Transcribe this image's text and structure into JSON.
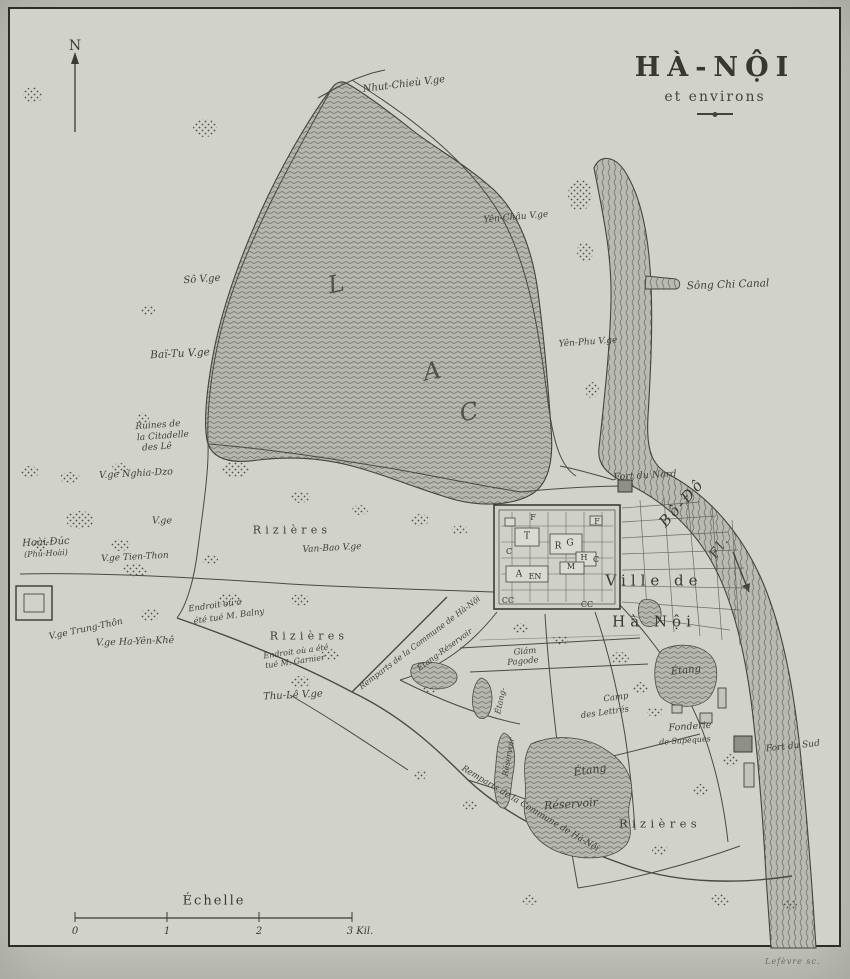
{
  "title": {
    "main": "HÀ-NỘI",
    "sub": "et environs"
  },
  "compass": {
    "label": "N"
  },
  "scale": {
    "label": "Échelle",
    "ticks": [
      "0",
      "1",
      "2",
      "3 Kil."
    ]
  },
  "credit": "Lefèvre sc.",
  "colors": {
    "paper": "#d1d2c9",
    "ink": "#3b3935",
    "water_base": "#b6b7ae",
    "water_line": "#6b6c63",
    "frame": "#2e2c27"
  },
  "labels": [
    {
      "text": "Nhut-Chieù V.ge",
      "x": 404,
      "y": 85,
      "s": 10,
      "r": -7,
      "cls": "i",
      "n": "label-nhut-chieu-village"
    },
    {
      "text": "Yên-Châu V.ge",
      "x": 516,
      "y": 218,
      "s": 9,
      "r": -5,
      "cls": "i",
      "n": "label-yen-chau-village"
    },
    {
      "text": "Sô V.ge",
      "x": 202,
      "y": 280,
      "s": 10,
      "r": -4,
      "cls": "i",
      "n": "label-so-village"
    },
    {
      "text": "Baï-Tu V.ge",
      "x": 180,
      "y": 354,
      "s": 10.5,
      "r": -3,
      "cls": "i",
      "n": "label-bai-tu-village"
    },
    {
      "text": "Yên-Phu V.ge",
      "x": 588,
      "y": 343,
      "s": 9,
      "r": -4,
      "cls": "i",
      "n": "label-yen-phu-village"
    },
    {
      "text": "Sông Chi Canal",
      "x": 728,
      "y": 285,
      "s": 10.5,
      "r": -2,
      "cls": "i",
      "n": "label-song-chi-canal"
    },
    {
      "text": "L",
      "x": 336,
      "y": 284,
      "s": 24,
      "r": -12,
      "cls": "big",
      "n": "label-lake-letter-l"
    },
    {
      "text": "A",
      "x": 432,
      "y": 371,
      "s": 24,
      "r": -12,
      "cls": "big",
      "n": "label-lake-letter-a"
    },
    {
      "text": "C",
      "x": 469,
      "y": 412,
      "s": 24,
      "r": -12,
      "cls": "big",
      "n": "label-lake-letter-c"
    },
    {
      "text": "Ruines de",
      "x": 158,
      "y": 426,
      "s": 9,
      "r": -4,
      "cls": "i",
      "n": "label-ruines-citadelle-line1"
    },
    {
      "text": "la Citadelle",
      "x": 163,
      "y": 437,
      "s": 9,
      "r": -4,
      "cls": "i",
      "n": "label-ruines-citadelle-line2"
    },
    {
      "text": "des Lê",
      "x": 157,
      "y": 448,
      "s": 9,
      "r": -4,
      "cls": "i",
      "n": "label-ruines-citadelle-line3"
    },
    {
      "text": "V.ge Nghia-Dzo",
      "x": 136,
      "y": 474,
      "s": 9.5,
      "r": -3,
      "cls": "i",
      "n": "label-nghia-dzo-village"
    },
    {
      "text": "V.ge",
      "x": 162,
      "y": 521,
      "s": 9.5,
      "r": 0,
      "cls": "i",
      "n": "label-village"
    },
    {
      "text": "Hoài-Đúc",
      "x": 46,
      "y": 543,
      "s": 10,
      "r": -3,
      "cls": "i",
      "n": "label-hoai-duc"
    },
    {
      "text": "(Phủ-Hoài)",
      "x": 46,
      "y": 554,
      "s": 8,
      "r": -3,
      "cls": "i",
      "n": "label-phu-hoai"
    },
    {
      "text": "V.ge Tien-Thon",
      "x": 135,
      "y": 558,
      "s": 9,
      "r": -3,
      "cls": "i",
      "n": "label-tien-thon-village"
    },
    {
      "text": "Rizières",
      "x": 292,
      "y": 530,
      "s": 11,
      "r": 0,
      "cls": "ls",
      "n": "label-rizieres-north"
    },
    {
      "text": "Van-Bao V.ge",
      "x": 332,
      "y": 549,
      "s": 9,
      "r": -3,
      "cls": "i",
      "n": "label-van-bao-village"
    },
    {
      "text": "Fort du Nord",
      "x": 645,
      "y": 476,
      "s": 9.5,
      "r": -3,
      "cls": "i",
      "n": "label-fort-du-nord"
    },
    {
      "text": "Bô-Đô",
      "x": 682,
      "y": 503,
      "s": 15,
      "r": -48,
      "cls": "riv",
      "n": "label-river-bo-do"
    },
    {
      "text": "Fl.",
      "x": 720,
      "y": 547,
      "s": 13,
      "r": -55,
      "cls": "riv",
      "n": "label-river-fleuve"
    },
    {
      "text": "Ville de",
      "x": 654,
      "y": 581,
      "s": 15,
      "r": 0,
      "cls": "city",
      "n": "label-ville-de"
    },
    {
      "text": "Hà Nội",
      "x": 654,
      "y": 622,
      "s": 15,
      "r": 0,
      "cls": "city",
      "n": "label-ha-noi"
    },
    {
      "text": "F",
      "x": 533,
      "y": 518,
      "s": 8,
      "r": 0,
      "cls": "key",
      "n": "label-citadel-key-f1"
    },
    {
      "text": "F",
      "x": 597,
      "y": 522,
      "s": 8,
      "r": 0,
      "cls": "key",
      "n": "label-citadel-key-f2"
    },
    {
      "text": "T",
      "x": 527,
      "y": 537,
      "s": 9,
      "r": 0,
      "cls": "key",
      "n": "label-citadel-key-t"
    },
    {
      "text": "R",
      "x": 558,
      "y": 547,
      "s": 9,
      "r": 0,
      "cls": "key",
      "n": "label-citadel-key-r"
    },
    {
      "text": "G",
      "x": 570,
      "y": 544,
      "s": 9,
      "r": 0,
      "cls": "key",
      "n": "label-citadel-key-g"
    },
    {
      "text": "C",
      "x": 509,
      "y": 552,
      "s": 8,
      "r": 0,
      "cls": "key",
      "n": "label-citadel-key-c1"
    },
    {
      "text": "H",
      "x": 584,
      "y": 558,
      "s": 8,
      "r": 0,
      "cls": "key",
      "n": "label-citadel-key-h"
    },
    {
      "text": "C",
      "x": 596,
      "y": 560,
      "s": 8,
      "r": 0,
      "cls": "key",
      "n": "label-citadel-key-c2"
    },
    {
      "text": "M",
      "x": 571,
      "y": 567,
      "s": 8,
      "r": 0,
      "cls": "key",
      "n": "label-citadel-key-m"
    },
    {
      "text": "A",
      "x": 519,
      "y": 575,
      "s": 9,
      "r": 0,
      "cls": "key",
      "n": "label-citadel-key-a"
    },
    {
      "text": "EN",
      "x": 535,
      "y": 577,
      "s": 8,
      "r": 0,
      "cls": "key",
      "n": "label-citadel-key-en"
    },
    {
      "text": "CC",
      "x": 508,
      "y": 601,
      "s": 8,
      "r": 0,
      "cls": "key",
      "n": "label-citadel-key-cc1"
    },
    {
      "text": "CC",
      "x": 587,
      "y": 605,
      "s": 8,
      "r": 0,
      "cls": "key",
      "n": "label-citadel-key-cc2"
    },
    {
      "text": "Endroit où a",
      "x": 215,
      "y": 606,
      "s": 8.5,
      "r": -8,
      "cls": "i",
      "n": "label-balny-line1"
    },
    {
      "text": "été tué M. Balny",
      "x": 229,
      "y": 617,
      "s": 8.5,
      "r": -8,
      "cls": "i",
      "n": "label-balny-line2"
    },
    {
      "text": "V.ge Trung-Thôn",
      "x": 86,
      "y": 630,
      "s": 9,
      "r": -12,
      "cls": "i",
      "n": "label-trung-thon-village"
    },
    {
      "text": "V.ge Ha-Yên-Khê",
      "x": 135,
      "y": 642,
      "s": 9.5,
      "r": -2,
      "cls": "i",
      "n": "label-ha-yen-khe-village"
    },
    {
      "text": "Rizières",
      "x": 309,
      "y": 636,
      "s": 11,
      "r": 0,
      "cls": "ls",
      "n": "label-rizieres-west"
    },
    {
      "text": "Endroit où a été",
      "x": 296,
      "y": 652,
      "s": 8,
      "r": -8,
      "cls": "i",
      "n": "label-garnier-line1"
    },
    {
      "text": "tué M. Garnier",
      "x": 295,
      "y": 662,
      "s": 8,
      "r": -8,
      "cls": "i",
      "n": "label-garnier-line2"
    },
    {
      "text": "Remparts de la Commune de Hà-Nội",
      "x": 420,
      "y": 643,
      "s": 8,
      "r": -37,
      "cls": "i",
      "n": "label-remparts-west"
    },
    {
      "text": "Étang-Réservoir",
      "x": 445,
      "y": 650,
      "s": 8,
      "r": -36,
      "cls": "i",
      "n": "label-etang-reservoir-nw"
    },
    {
      "text": "Thu-Lê V.ge",
      "x": 293,
      "y": 696,
      "s": 10,
      "r": -3,
      "cls": "i",
      "n": "label-thu-le-village"
    },
    {
      "text": "Giám",
      "x": 525,
      "y": 652,
      "s": 8.5,
      "r": -5,
      "cls": "i",
      "n": "label-giam-pagode-line1"
    },
    {
      "text": "Pagode",
      "x": 523,
      "y": 662,
      "s": 8.5,
      "r": -5,
      "cls": "i",
      "n": "label-giam-pagode-line2"
    },
    {
      "text": "Étang-",
      "x": 501,
      "y": 701,
      "s": 8,
      "r": -78,
      "cls": "i",
      "n": "label-etang-vertical"
    },
    {
      "text": "Réservoir",
      "x": 509,
      "y": 757,
      "s": 8,
      "r": -80,
      "cls": "i",
      "n": "label-reservoir-vertical"
    },
    {
      "text": "Camp",
      "x": 616,
      "y": 698,
      "s": 8.5,
      "r": -8,
      "cls": "i",
      "n": "label-camp-lettres-line1"
    },
    {
      "text": "des Lettrés",
      "x": 605,
      "y": 713,
      "s": 8.5,
      "r": -8,
      "cls": "i",
      "n": "label-camp-lettres-line2"
    },
    {
      "text": "Étang",
      "x": 686,
      "y": 671,
      "s": 10,
      "r": -6,
      "cls": "i",
      "n": "label-etang-east"
    },
    {
      "text": "Fonderie",
      "x": 690,
      "y": 727,
      "s": 9.5,
      "r": -4,
      "cls": "i",
      "n": "label-fonderie-line1"
    },
    {
      "text": "de Sapèques",
      "x": 685,
      "y": 741,
      "s": 8,
      "r": -4,
      "cls": "i",
      "n": "label-fonderie-line2"
    },
    {
      "text": "Fort du Sud",
      "x": 793,
      "y": 747,
      "s": 9,
      "r": -6,
      "cls": "i",
      "n": "label-fort-du-sud"
    },
    {
      "text": "Étang",
      "x": 590,
      "y": 770,
      "s": 11,
      "r": -8,
      "cls": "i",
      "n": "label-etang-big"
    },
    {
      "text": "Réservoir",
      "x": 571,
      "y": 804,
      "s": 11,
      "r": -4,
      "cls": "i",
      "n": "label-reservoir-big"
    },
    {
      "text": "Rizières",
      "x": 660,
      "y": 824,
      "s": 11.5,
      "r": 0,
      "cls": "ls",
      "n": "label-rizieres-south"
    },
    {
      "text": "Remparts de la Commune de Hà-Nội",
      "x": 530,
      "y": 809,
      "s": 8.5,
      "r": 31,
      "cls": "i",
      "n": "label-remparts-south"
    }
  ]
}
